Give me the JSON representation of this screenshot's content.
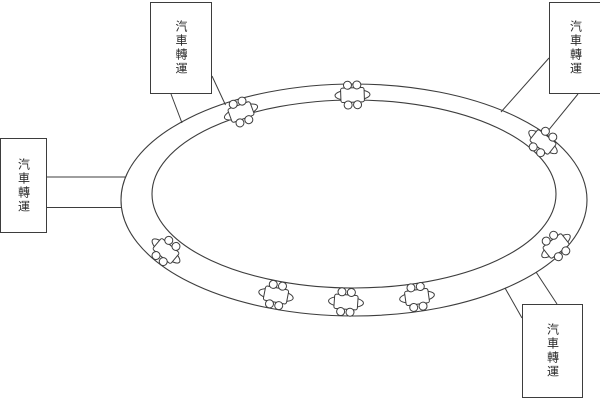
{
  "diagram": {
    "title_hint": "car-transfer-loop-diagram",
    "background_color": "#ffffff",
    "stroke_color": "#3d3d3d",
    "label_text": "汽車轉運",
    "boxes": [
      {
        "id": "top-left",
        "label": "汽車轉運",
        "x": 150,
        "y": 2,
        "w": 62,
        "h": 92
      },
      {
        "id": "left",
        "label": "汽車轉運",
        "x": 0,
        "y": 138,
        "w": 47,
        "h": 95
      },
      {
        "id": "top-right",
        "label": "汽車轉運",
        "x": 549,
        "y": 2,
        "w": 53,
        "h": 92
      },
      {
        "id": "bottom-right",
        "label": "汽車轉運",
        "x": 522,
        "y": 304,
        "w": 61,
        "h": 94
      }
    ],
    "ring": {
      "outer": {
        "cx": 354,
        "cy": 200,
        "rx": 233,
        "ry": 116
      },
      "inner": {
        "cx": 354,
        "cy": 194,
        "rx": 202,
        "ry": 94
      }
    },
    "connectors": [
      {
        "from_box": "top-left",
        "x1": 171,
        "y1": 94,
        "x2": 182,
        "y2": 123
      },
      {
        "from_box": "top-left",
        "x1": 212,
        "y1": 76,
        "x2": 225.5,
        "y2": 105
      },
      {
        "from_box": "left",
        "x1": 47,
        "y1": 177,
        "x2": 126,
        "y2": 177
      },
      {
        "from_box": "left",
        "x1": 47,
        "y1": 207.5,
        "x2": 121.5,
        "y2": 207.5
      },
      {
        "from_box": "top-right",
        "x1": 549,
        "y1": 58,
        "x2": 501,
        "y2": 112
      },
      {
        "from_box": "top-right",
        "x1": 578,
        "y1": 94,
        "x2": 543,
        "y2": 137
      },
      {
        "from_box": "bottom-right",
        "x1": 505,
        "y1": 288,
        "x2": 522,
        "y2": 318
      },
      {
        "from_box": "bottom-right",
        "x1": 536,
        "y1": 272,
        "x2": 557,
        "y2": 304
      }
    ],
    "vehicle_icon": {
      "body_rx": 17.5,
      "body_ry": 5.6,
      "cab_w": 23.5,
      "cab_h": 14.4,
      "cab_corner": 2,
      "wheel_r": 4,
      "wheel_dx": 4.7,
      "wheel_dy": 9.9
    },
    "vehicles": [
      {
        "pos": "north-west",
        "x": 241,
        "y": 112,
        "rot": -20
      },
      {
        "pos": "north",
        "x": 352.5,
        "y": 95,
        "rot": -2
      },
      {
        "pos": "north-east",
        "x": 543,
        "y": 142,
        "rot": 38
      },
      {
        "pos": "south-east",
        "x": 556,
        "y": 246,
        "rot": -38
      },
      {
        "pos": "south-west",
        "x": 166,
        "y": 251,
        "rot": 40
      },
      {
        "pos": "south-left",
        "x": 276,
        "y": 295,
        "rot": 11
      },
      {
        "pos": "south-middle",
        "x": 346,
        "y": 302,
        "rot": 4
      },
      {
        "pos": "south-right",
        "x": 417,
        "y": 297,
        "rot": -8
      }
    ]
  }
}
